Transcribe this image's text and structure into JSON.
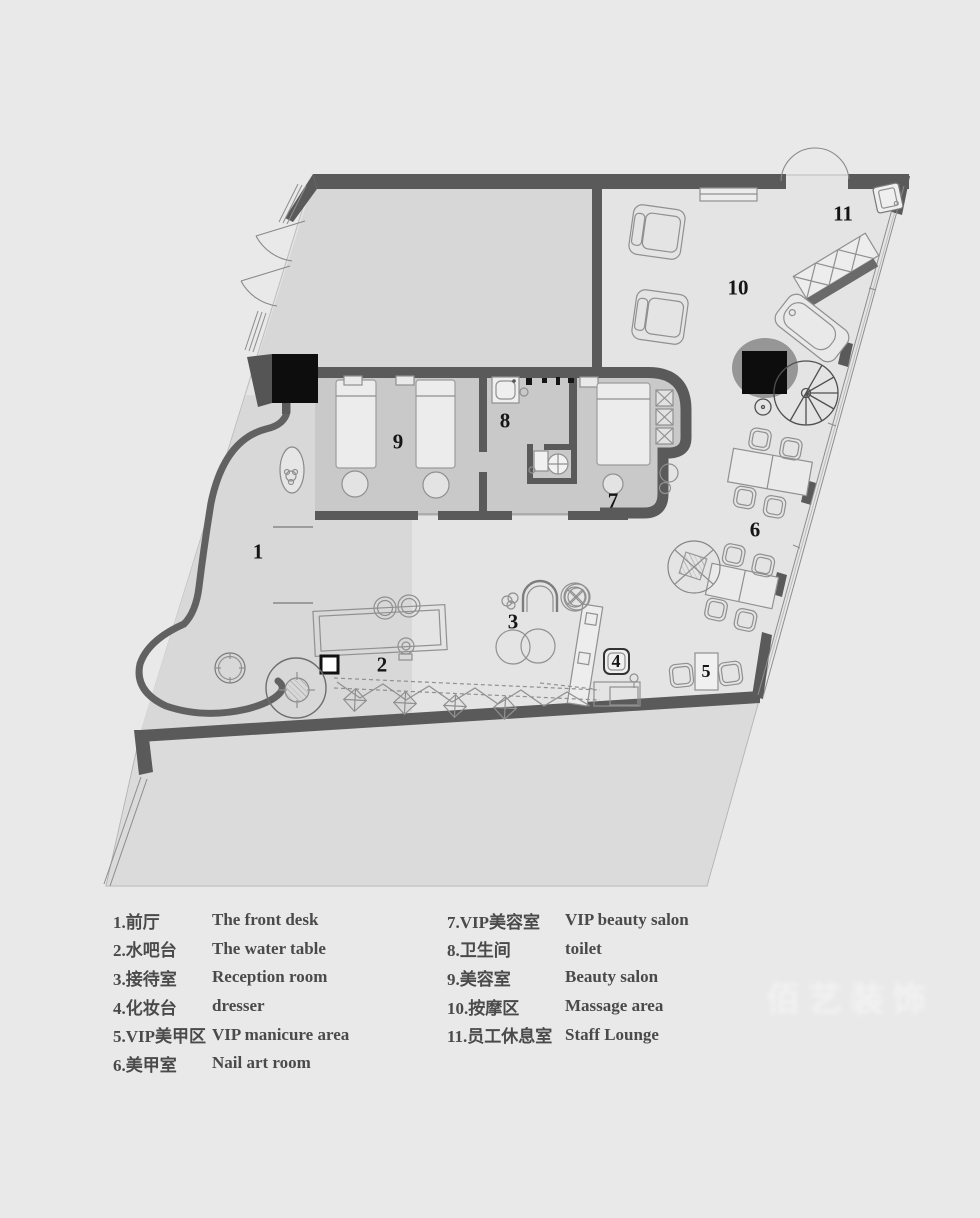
{
  "title": "Beauty salon floor plan",
  "watermark": "佰艺装饰",
  "plan": {
    "colors": {
      "background": "#e9e9e9",
      "main_floor": "#e4e4e4",
      "upper_room_floor": "#d7d7d7",
      "treatment_strip_floor": "#c9c9c9",
      "front_hall_floor": "#d8d8d8",
      "terrace_floor": "#dbdbdb",
      "wall": "#5a5a5a",
      "column_black": "#0d0d0d",
      "furniture_line": "#909090"
    },
    "room_labels": [
      {
        "id": "1",
        "x": 258,
        "y": 552
      },
      {
        "id": "2",
        "x": 382,
        "y": 665
      },
      {
        "id": "3",
        "x": 513,
        "y": 622
      },
      {
        "id": "4",
        "x": 616,
        "y": 661
      },
      {
        "id": "5",
        "x": 706,
        "y": 671
      },
      {
        "id": "6",
        "x": 755,
        "y": 530
      },
      {
        "id": "7",
        "x": 613,
        "y": 501
      },
      {
        "id": "8",
        "x": 505,
        "y": 421
      },
      {
        "id": "9",
        "x": 398,
        "y": 442
      },
      {
        "id": "10",
        "x": 738,
        "y": 288
      },
      {
        "id": "11",
        "x": 843,
        "y": 214
      }
    ]
  },
  "legend": {
    "left": [
      {
        "zh": "1.前厅",
        "en": "The front desk"
      },
      {
        "zh": "2.水吧台",
        "en": "The water table"
      },
      {
        "zh": "3.接待室",
        "en": "Reception room"
      },
      {
        "zh": "4.化妆台",
        "en": "dresser"
      },
      {
        "zh": "5.VIP美甲区",
        "en": "VIP manicure area"
      },
      {
        "zh": "6.美甲室",
        "en": "Nail art room"
      }
    ],
    "right": [
      {
        "zh": "7.VIP美容室",
        "en": "VIP beauty salon"
      },
      {
        "zh": "8.卫生间",
        "en": "toilet"
      },
      {
        "zh": "9.美容室",
        "en": "Beauty salon"
      },
      {
        "zh": "10.按摩区",
        "en": "Massage area"
      },
      {
        "zh": "11.员工休息室",
        "en": "Staff Lounge"
      }
    ]
  }
}
